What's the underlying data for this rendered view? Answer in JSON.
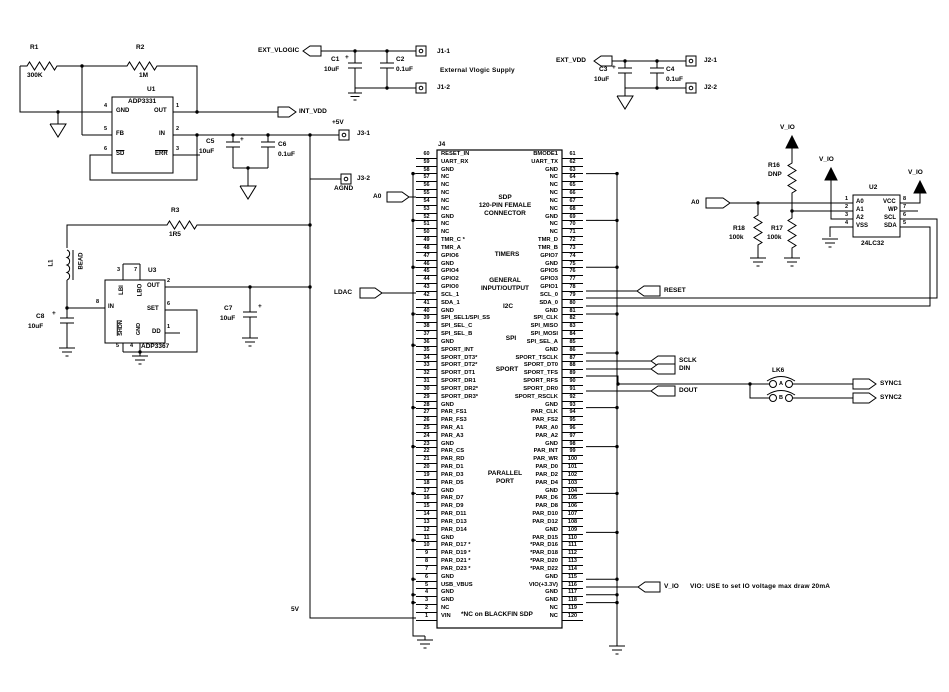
{
  "plus": "+",
  "resistors": {
    "r1": {
      "ref": "R1",
      "value": "300K"
    },
    "r2": {
      "ref": "R2",
      "value": "1M"
    },
    "r3": {
      "ref": "R3",
      "value": "1R5"
    },
    "r16": {
      "ref": "R16",
      "value": "DNP"
    },
    "r17": {
      "ref": "R17",
      "value": "100k"
    },
    "r18": {
      "ref": "R18",
      "value": "100k"
    }
  },
  "inductor": {
    "ref": "L1",
    "value": "BEAD"
  },
  "capacitors": {
    "c1": {
      "ref": "C1",
      "value": "10uF"
    },
    "c2": {
      "ref": "C2",
      "value": "0.1uF"
    },
    "c3": {
      "ref": "C3",
      "value": "10uF"
    },
    "c4": {
      "ref": "C4",
      "value": "0.1uF"
    },
    "c5": {
      "ref": "C5",
      "value": "10uF"
    },
    "c6": {
      "ref": "C6",
      "value": "0.1uF"
    },
    "c7": {
      "ref": "C7",
      "value": "10uF"
    },
    "c8": {
      "ref": "C8",
      "value": "10uF"
    }
  },
  "u1": {
    "ref": "U1",
    "part": "ADP3331",
    "pins": {
      "gnd": {
        "num": "4",
        "name": "GND"
      },
      "out": {
        "num": "1",
        "name": "OUT"
      },
      "fb": {
        "num": "5",
        "name": "FB"
      },
      "in": {
        "num": "2",
        "name": "IN"
      },
      "sd": {
        "num": "6",
        "name": "SD"
      },
      "err": {
        "num": "3",
        "name": "ERR"
      }
    }
  },
  "u2": {
    "ref": "U2",
    "part": "24LC32",
    "pins": {
      "a0": {
        "num": "1",
        "name": "A0"
      },
      "a1": {
        "num": "2",
        "name": "A1"
      },
      "a2": {
        "num": "3",
        "name": "A2"
      },
      "vss": {
        "num": "4",
        "name": "VSS"
      },
      "vcc": {
        "num": "8",
        "name": "VCC"
      },
      "wp": {
        "num": "7",
        "name": "WP"
      },
      "scl": {
        "num": "6",
        "name": "SCL"
      },
      "sda": {
        "num": "5",
        "name": "SDA"
      }
    }
  },
  "u3": {
    "ref": "U3",
    "part": "ADP3367",
    "pins": {
      "lbi": {
        "num": "3",
        "name": "LBI"
      },
      "lbo": {
        "num": "7",
        "name": "LBO"
      },
      "out": {
        "num": "2",
        "name": "OUT"
      },
      "set": {
        "num": "6",
        "name": "SET"
      },
      "dd": {
        "num": "1",
        "name": "DD"
      },
      "in": {
        "num": "8",
        "name": "IN"
      },
      "shdn": {
        "num": "5",
        "name": "SHDN"
      },
      "gnd": {
        "num": "4",
        "name": "GND"
      }
    }
  },
  "nets": {
    "ext_vlogic": "EXT_VLOGIC",
    "int_vdd": "INT_VDD",
    "ext_vdd": "EXT_VDD",
    "a0_left": "A0",
    "a0_right": "A0",
    "ldac": "LDAC",
    "reset": "RESET",
    "sclk": "SCLK",
    "din": "DIN",
    "dout": "DOUT",
    "sync1": "SYNC1",
    "sync2": "SYNC2",
    "vio": "V_IO",
    "plus5v": "+5V",
    "fivev": "5V",
    "agnd": "AGND"
  },
  "pads": {
    "j1_1": "J1-1",
    "j1_2": "J1-2",
    "j2_1": "J2-1",
    "j2_2": "J2-2",
    "j3_1": "J3-1",
    "j3_2": "J3-2"
  },
  "lk6": {
    "ref": "LK6",
    "a": "A",
    "b": "B"
  },
  "notes": {
    "ext_supply": "External Vlogic Supply",
    "vio_note": "VIO: USE to set IO voltage max draw 20mA",
    "nc_note": "*NC on BLACKFIN SDP"
  },
  "j4": {
    "ref": "J4",
    "title1": "SDP",
    "title2": "120-PIN FEMALE",
    "title3": "CONNECTOR",
    "sections": {
      "timers": "TIMERS",
      "gio1": "GENERAL",
      "gio2": "INPUT/OUTPUT",
      "i2c": "I2C",
      "spi": "SPI",
      "sport": "SPORT",
      "par1": "PARALLEL",
      "par2": "PORT"
    },
    "left_pins": [
      {
        "pin": "60",
        "label": "RESET_IN"
      },
      {
        "pin": "59",
        "label": "UART_RX"
      },
      {
        "pin": "58",
        "label": "GND"
      },
      {
        "pin": "57",
        "label": "NC"
      },
      {
        "pin": "56",
        "label": "NC"
      },
      {
        "pin": "55",
        "label": "NC"
      },
      {
        "pin": "54",
        "label": "NC"
      },
      {
        "pin": "53",
        "label": "NC"
      },
      {
        "pin": "52",
        "label": "GND"
      },
      {
        "pin": "51",
        "label": "NC"
      },
      {
        "pin": "50",
        "label": "NC"
      },
      {
        "pin": "49",
        "label": "TMR_C *"
      },
      {
        "pin": "48",
        "label": "TMR_A"
      },
      {
        "pin": "47",
        "label": "GPIO6"
      },
      {
        "pin": "46",
        "label": "GND"
      },
      {
        "pin": "45",
        "label": "GPIO4"
      },
      {
        "pin": "44",
        "label": "GPIO2"
      },
      {
        "pin": "43",
        "label": "GPIO0"
      },
      {
        "pin": "42",
        "label": "SCL_1"
      },
      {
        "pin": "41",
        "label": "SDA_1"
      },
      {
        "pin": "40",
        "label": "GND"
      },
      {
        "pin": "39",
        "label": "SPI_SEL1/SPI_SS"
      },
      {
        "pin": "38",
        "label": "SPI_SEL_C"
      },
      {
        "pin": "37",
        "label": "SPI_SEL_B"
      },
      {
        "pin": "36",
        "label": "GND"
      },
      {
        "pin": "35",
        "label": "SPORT_INT"
      },
      {
        "pin": "34",
        "label": "SPORT_DT3*"
      },
      {
        "pin": "33",
        "label": "SPORT_DT2*"
      },
      {
        "pin": "32",
        "label": "SPORT_DT1"
      },
      {
        "pin": "31",
        "label": "SPORT_DR1"
      },
      {
        "pin": "30",
        "label": "SPORT_DR2*"
      },
      {
        "pin": "29",
        "label": "SPORT_DR3*"
      },
      {
        "pin": "28",
        "label": "GND"
      },
      {
        "pin": "27",
        "label": "PAR_FS1"
      },
      {
        "pin": "26",
        "label": "PAR_FS3"
      },
      {
        "pin": "25",
        "label": "PAR_A1"
      },
      {
        "pin": "24",
        "label": "PAR_A3"
      },
      {
        "pin": "23",
        "label": "GND"
      },
      {
        "pin": "22",
        "label": "PAR_CS"
      },
      {
        "pin": "21",
        "label": "PAR_RD"
      },
      {
        "pin": "20",
        "label": "PAR_D1"
      },
      {
        "pin": "19",
        "label": "PAR_D3"
      },
      {
        "pin": "18",
        "label": "PAR_D5"
      },
      {
        "pin": "17",
        "label": "GND"
      },
      {
        "pin": "16",
        "label": "PAR_D7"
      },
      {
        "pin": "15",
        "label": "PAR_D9"
      },
      {
        "pin": "14",
        "label": "PAR_D11"
      },
      {
        "pin": "13",
        "label": "PAR_D13"
      },
      {
        "pin": "12",
        "label": "PAR_D14"
      },
      {
        "pin": "11",
        "label": "GND"
      },
      {
        "pin": "10",
        "label": "PAR_D17 *"
      },
      {
        "pin": "9",
        "label": "PAR_D19 *"
      },
      {
        "pin": "8",
        "label": "PAR_D21 *"
      },
      {
        "pin": "7",
        "label": "PAR_D23 *"
      },
      {
        "pin": "6",
        "label": "GND"
      },
      {
        "pin": "5",
        "label": "USB_VBUS"
      },
      {
        "pin": "4",
        "label": "GND"
      },
      {
        "pin": "3",
        "label": "GND"
      },
      {
        "pin": "2",
        "label": "NC"
      },
      {
        "pin": "1",
        "label": "VIN"
      }
    ],
    "right_pins": [
      {
        "pin": "61",
        "label": "BMODE1"
      },
      {
        "pin": "62",
        "label": "UART_TX"
      },
      {
        "pin": "63",
        "label": "GND"
      },
      {
        "pin": "64",
        "label": "NC"
      },
      {
        "pin": "65",
        "label": "NC"
      },
      {
        "pin": "66",
        "label": "NC"
      },
      {
        "pin": "67",
        "label": "NC"
      },
      {
        "pin": "68",
        "label": "NC"
      },
      {
        "pin": "69",
        "label": "GND"
      },
      {
        "pin": "70",
        "label": "NC"
      },
      {
        "pin": "71",
        "label": "NC"
      },
      {
        "pin": "72",
        "label": "TMR_D"
      },
      {
        "pin": "73",
        "label": "TMR_B"
      },
      {
        "pin": "74",
        "label": "GPIO7"
      },
      {
        "pin": "75",
        "label": "GND"
      },
      {
        "pin": "76",
        "label": "GPIO5"
      },
      {
        "pin": "77",
        "label": "GPIO3"
      },
      {
        "pin": "78",
        "label": "GPIO1"
      },
      {
        "pin": "79",
        "label": "SCL_0"
      },
      {
        "pin": "80",
        "label": "SDA_0"
      },
      {
        "pin": "81",
        "label": "GND"
      },
      {
        "pin": "82",
        "label": "SPI_CLK"
      },
      {
        "pin": "83",
        "label": "SPI_MISO"
      },
      {
        "pin": "84",
        "label": "SPI_MOSI"
      },
      {
        "pin": "85",
        "label": "SPI_SEL_A"
      },
      {
        "pin": "86",
        "label": "GND"
      },
      {
        "pin": "87",
        "label": "SPORT_TSCLK"
      },
      {
        "pin": "88",
        "label": "SPORT_DT0"
      },
      {
        "pin": "89",
        "label": "SPORT_TFS"
      },
      {
        "pin": "90",
        "label": "SPORT_RFS"
      },
      {
        "pin": "91",
        "label": "SPORT_DR0"
      },
      {
        "pin": "92",
        "label": "SPORT_RSCLK"
      },
      {
        "pin": "93",
        "label": "GND"
      },
      {
        "pin": "94",
        "label": "PAR_CLK"
      },
      {
        "pin": "95",
        "label": "PAR_FS2"
      },
      {
        "pin": "96",
        "label": "PAR_A0"
      },
      {
        "pin": "97",
        "label": "PAR_A2"
      },
      {
        "pin": "98",
        "label": "GND"
      },
      {
        "pin": "99",
        "label": "PAR_INT"
      },
      {
        "pin": "100",
        "label": "PAR_WR"
      },
      {
        "pin": "101",
        "label": "PAR_D0"
      },
      {
        "pin": "102",
        "label": "PAR_D2"
      },
      {
        "pin": "103",
        "label": "PAR_D4"
      },
      {
        "pin": "104",
        "label": "GND"
      },
      {
        "pin": "105",
        "label": "PAR_D6"
      },
      {
        "pin": "106",
        "label": "PAR_D8"
      },
      {
        "pin": "107",
        "label": "PAR_D10"
      },
      {
        "pin": "108",
        "label": "PAR_D12"
      },
      {
        "pin": "109",
        "label": "GND"
      },
      {
        "pin": "110",
        "label": "PAR_D15"
      },
      {
        "pin": "111",
        "label": "*PAR_D16"
      },
      {
        "pin": "112",
        "label": "*PAR_D18"
      },
      {
        "pin": "113",
        "label": "*PAR_D20"
      },
      {
        "pin": "114",
        "label": "*PAR_D22"
      },
      {
        "pin": "115",
        "label": "GND"
      },
      {
        "pin": "116",
        "label": "VIO(+3.3V)"
      },
      {
        "pin": "117",
        "label": "GND"
      },
      {
        "pin": "118",
        "label": "GND"
      },
      {
        "pin": "119",
        "label": "NC"
      },
      {
        "pin": "120",
        "label": "NC"
      }
    ]
  }
}
